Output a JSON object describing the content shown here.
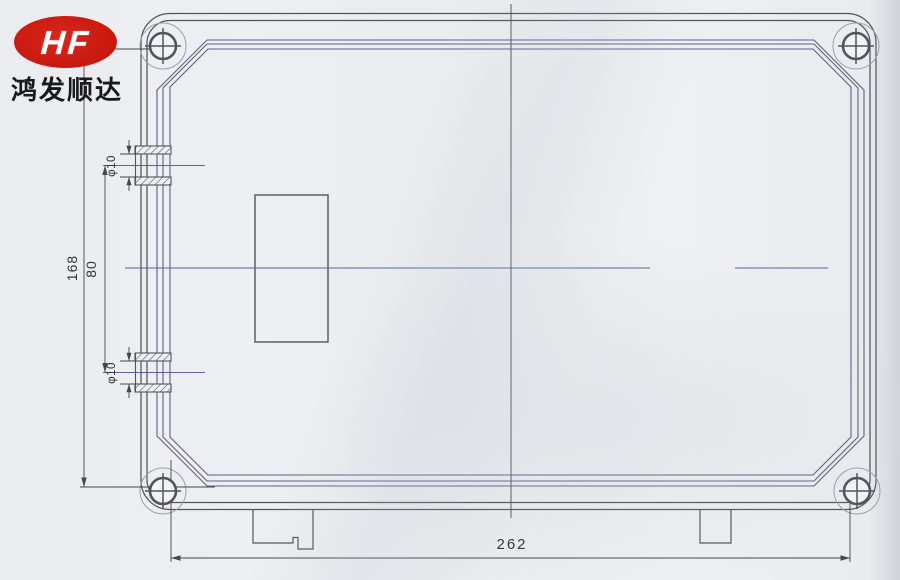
{
  "logo": {
    "monogram": "HF",
    "company_name": "鸿发顺达",
    "brand_color": "#c8190f"
  },
  "drawing": {
    "dimensions": {
      "overall_width": "262",
      "mount_height": "168",
      "entry_spacing": "80",
      "entry_dia_top": "φ10",
      "entry_dia_bottom": "φ10"
    },
    "colors": {
      "line": "#55535e",
      "frame_line": "#5e6186",
      "centerline": "#5564a2",
      "dim_line": "#46464e",
      "dim_text": "#323238",
      "company_text": "#1a1a1d"
    }
  }
}
